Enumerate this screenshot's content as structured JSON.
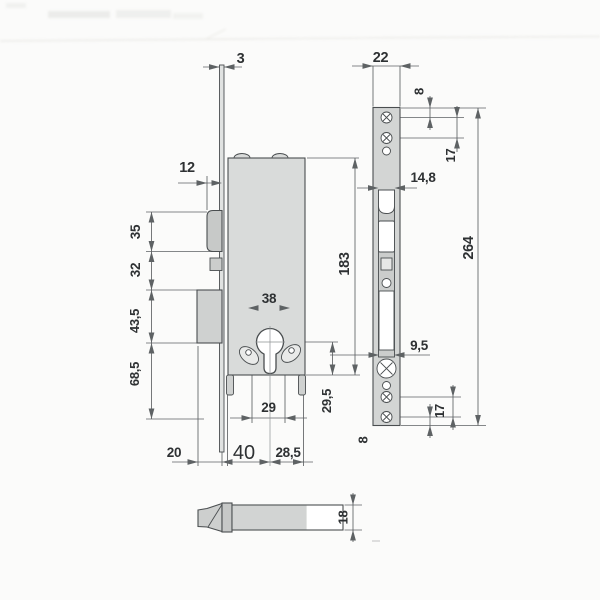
{
  "drawing": {
    "dimensions": {
      "left": {
        "faceplate_thickness": "3",
        "latch_projection": "12",
        "latch_height": "35",
        "latch_to_deadbolt": "32",
        "deadbolt_height": "43,5",
        "below_deadbolt": "68,5",
        "body_height": "183",
        "cylinder_screws_width": "38",
        "cylinder_slot_width": "29",
        "cylinder_to_bottom": "29,5",
        "bolt_throw": "20",
        "backset": "40",
        "body_depth_rear": "28,5"
      },
      "front": {
        "faceplate_width": "22",
        "edge_to_hole": "8",
        "hole_spacing_top": "17",
        "channel_width": "14,8",
        "faceplate_length": "264",
        "bolt_window_width": "9,5",
        "hole_spacing_bottom": "17",
        "hole_to_edge_bottom": "8"
      },
      "bolt": {
        "height": "18"
      }
    },
    "colors": {
      "background": "#fbfbfa",
      "body_fill": "#d9dbda",
      "faceplate_fill": "#d3d5d4",
      "channel_fill": "#cbcdcc",
      "outline": "#4a4e50",
      "dim_line": "#5e6264",
      "text": "#2e3133"
    }
  }
}
